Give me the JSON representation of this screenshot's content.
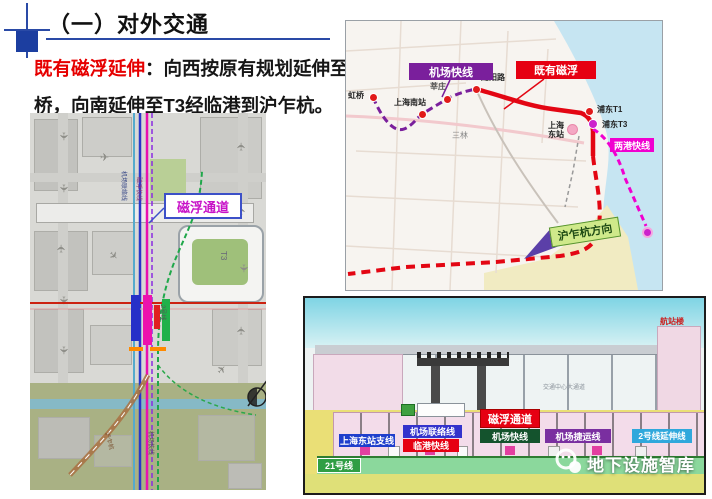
{
  "header": {
    "title": "（一）对外交通",
    "lead_highlight": "既有磁浮延伸",
    "lead_rest": "：向西按原有规划延伸至虹桥，向南延伸至T3经临港到沪乍杭。"
  },
  "plan_map": {
    "corridor_badge": "磁浮通道",
    "t3": "T3",
    "line_labels": {
      "airport_link": "机场联络线",
      "maglev_express": "磁浮快线",
      "line2": "2号线",
      "airport_express": "机场快线",
      "huzhahang": "沪乍杭"
    }
  },
  "region_map": {
    "badges": {
      "airport_express": "机场快线",
      "existing_maglev": "既有磁浮",
      "lianggang_express": "两港快线"
    },
    "direction": "沪乍杭方向",
    "stations": {
      "hongqiao": "虹桥",
      "south_station": "上海南站",
      "xinzhuang": "莘庄",
      "longyang": "龙阳路",
      "pudong_t1": "浦东T1",
      "pudong_t3": "浦东T3",
      "east_station": "上海东站",
      "sanlin": "三林"
    }
  },
  "section": {
    "terminal": "航站楼",
    "corridor_note": "交通中心大通道",
    "badges": {
      "line21": "21号线",
      "east_station_branch": "上海东站支线",
      "airport_link": "机场联络线",
      "lingang_express": "临港快线",
      "maglev_corridor": "磁浮通道",
      "airport_express": "机场快线",
      "airport_apm": "机场捷运线",
      "line2_ext": "2号线延伸线"
    },
    "watermark": "地下设施智库"
  },
  "icons": {
    "plane": "✈"
  },
  "colors": {
    "accent_blue": "#2a4aa6",
    "red": "#e60012",
    "purple": "#7a1f9c",
    "magenta": "#f000d0",
    "green_badge": "#2f9e44",
    "dark_green": "#14532d",
    "light_blue": "#2fa8dc"
  }
}
